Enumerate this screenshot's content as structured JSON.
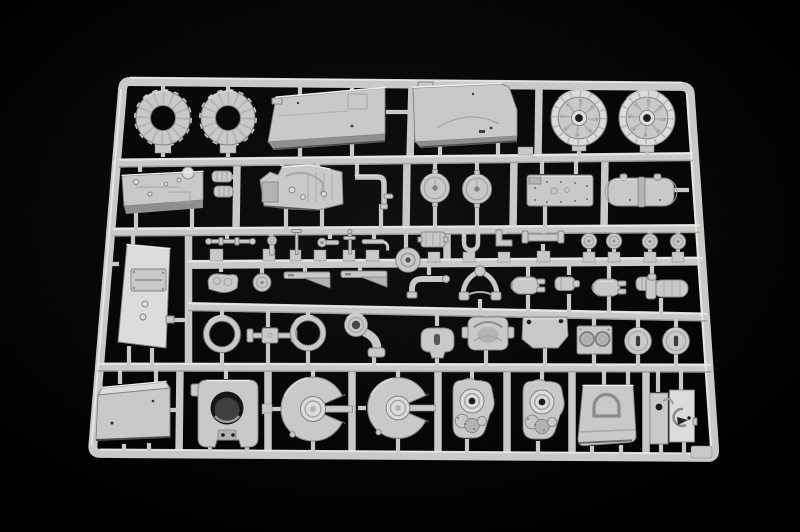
{
  "scene": {
    "type": "photograph",
    "subject": "Injection-molded plastic model kit sprue (parts tree) for an armored vehicle kit",
    "backdrop": "black seamless studio background",
    "material": "light grey styrene plastic",
    "colors": {
      "background": "#000000",
      "background_glow": "#101010",
      "plastic": "#c9c9c7",
      "plastic_light": "#dcdcda",
      "plastic_mid": "#b3b3b1",
      "plastic_shadow": "#8e8e8c",
      "plastic_highlight": "#edede9",
      "edge": "#82827f",
      "detail": "#a5a5a3",
      "hole": "#1c1c1a"
    }
  },
  "sprue": {
    "frame": "rectangular runner frame with five horizontal rails and vertical runners, photographed at a slight perspective angle",
    "rows": [
      {
        "row": 1,
        "parts": [
          "drive sprocket ring",
          "drive sprocket ring",
          "hull roof panel",
          "engine deck panel",
          "road wheel",
          "road wheel"
        ]
      },
      {
        "row": 2,
        "parts": [
          "gearbox housing",
          "cable drum pair",
          "engine block",
          "exhaust elbow pipe",
          "round hatch",
          "round hatch",
          "bolted access plate",
          "exhaust muffler"
        ]
      },
      {
        "row": 3,
        "parts": [
          "rear door panel",
          "tow axle rod",
          "periscope head",
          "hitch pin",
          "gun sight",
          "valve stem",
          "tow hook",
          "compressor unit",
          "hub cap",
          "fender bracket",
          "fender bracket",
          "junction hub cap",
          "cable spool",
          "u-clamp",
          "angle bracket",
          "leaf spring strip",
          "hub cap",
          "hub cap",
          "hub cap",
          "hub cap",
          "hose elbow",
          "suspension yoke",
          "cylinder sleeve",
          "coupling",
          "cylinder sleeve",
          "coupling",
          "capped cylinder"
        ]
      },
      {
        "row": 4,
        "parts": [
          "tire ring",
          "torsion axle link",
          "tire ring",
          "drain pipe",
          "swing arm boss",
          "gun cradle",
          "mounting plate",
          "twin instrument panel",
          "slotted wheel hub",
          "slotted wheel hub"
        ]
      },
      {
        "row": 5,
        "parts": [
          "stowage box",
          "trunnion mount",
          "idler wheel half",
          "idler wheel half",
          "final drive housing",
          "final drive housing",
          "arched cover plate",
          "hinged access plates"
        ]
      }
    ]
  }
}
